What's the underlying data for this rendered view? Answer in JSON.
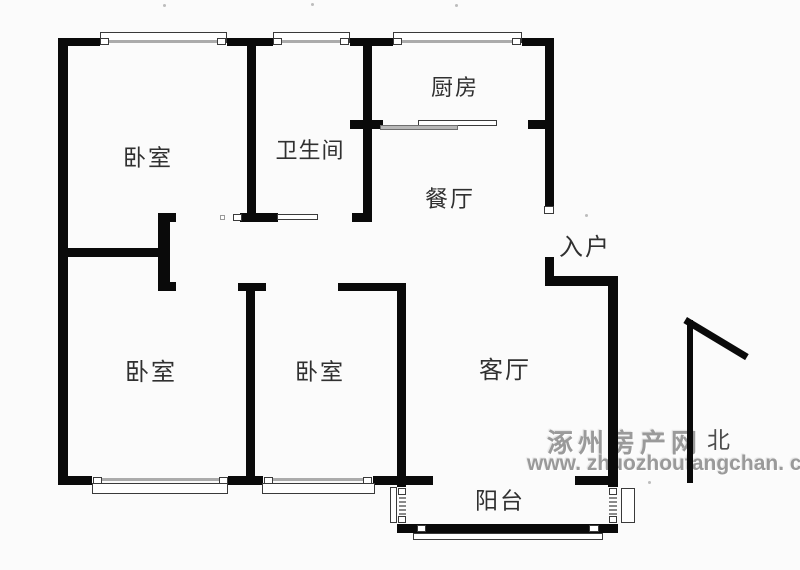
{
  "page": {
    "width": 800,
    "height": 570,
    "background": "#fbfbfb"
  },
  "colors": {
    "wall": "#0a0a0a",
    "thin_line": "#3a3a3a",
    "window_bar": "#ababab",
    "label_text": "#303030",
    "north_text": "#4d4d4d",
    "watermark": "#9a9a9a",
    "artifact_dot": "#bdbdbd"
  },
  "rooms": [
    {
      "id": "bedroom-top-left",
      "label": "卧室",
      "cx": 148,
      "cy": 158,
      "size": 23,
      "ls": 2
    },
    {
      "id": "bathroom",
      "label": "卫生间",
      "cx": 310,
      "cy": 151,
      "size": 22,
      "ls": 1
    },
    {
      "id": "kitchen",
      "label": "厨房",
      "cx": 455,
      "cy": 88,
      "size": 22,
      "ls": 2
    },
    {
      "id": "dining-room",
      "label": "餐厅",
      "cx": 450,
      "cy": 199,
      "size": 23,
      "ls": 2
    },
    {
      "id": "entry",
      "label": "入户",
      "cx": 585,
      "cy": 248,
      "size": 24,
      "ls": 2
    },
    {
      "id": "bedroom-bottom-left",
      "label": "卧室",
      "cx": 151,
      "cy": 373,
      "size": 24,
      "ls": 2
    },
    {
      "id": "bedroom-bottom-middle",
      "label": "卧室",
      "cx": 320,
      "cy": 372,
      "size": 23,
      "ls": 2
    },
    {
      "id": "living-room",
      "label": "客厅",
      "cx": 505,
      "cy": 371,
      "size": 24,
      "ls": 2
    },
    {
      "id": "balcony",
      "label": "阳台",
      "cx": 500,
      "cy": 501,
      "size": 23,
      "ls": 2
    }
  ],
  "north": {
    "label": "北",
    "x": 707,
    "y": 429
  },
  "watermark": {
    "line1": "涿州房产网",
    "line2": "www. zhuozhoufangchan. com"
  },
  "floorplan": {
    "walls": [
      [
        58,
        38,
        42,
        8
      ],
      [
        227,
        38,
        46,
        8
      ],
      [
        350,
        38,
        43,
        8
      ],
      [
        522,
        38,
        32,
        8
      ],
      [
        58,
        38,
        10,
        447
      ],
      [
        247,
        44,
        9,
        170
      ],
      [
        363,
        44,
        9,
        170
      ],
      [
        350,
        120,
        33,
        9
      ],
      [
        528,
        120,
        18,
        9
      ],
      [
        545,
        38,
        9,
        175
      ],
      [
        545,
        257,
        9,
        25
      ],
      [
        545,
        276,
        73,
        10
      ],
      [
        608,
        276,
        10,
        257
      ],
      [
        240,
        213,
        38,
        9
      ],
      [
        352,
        213,
        20,
        9
      ],
      [
        58,
        248,
        100,
        9
      ],
      [
        158,
        213,
        12,
        78
      ],
      [
        158,
        213,
        18,
        9
      ],
      [
        158,
        282,
        18,
        9
      ],
      [
        238,
        283,
        28,
        8
      ],
      [
        246,
        291,
        9,
        186
      ],
      [
        338,
        283,
        67,
        8
      ],
      [
        397,
        283,
        9,
        250
      ],
      [
        58,
        476,
        34,
        9
      ],
      [
        228,
        476,
        35,
        9
      ],
      [
        373,
        476,
        60,
        9
      ],
      [
        575,
        476,
        43,
        9
      ],
      [
        402,
        524,
        216,
        9
      ],
      [
        687,
        320,
        6,
        163
      ]
    ],
    "covers": [
      [
        397,
        487,
        9,
        37
      ],
      [
        608,
        487,
        10,
        37
      ]
    ],
    "thin_rects": [
      [
        100,
        32,
        127,
        11,
        "window-frame"
      ],
      [
        273,
        32,
        77,
        11,
        "window-frame"
      ],
      [
        393,
        32,
        129,
        11,
        "window-frame"
      ],
      [
        92,
        483,
        136,
        11,
        "window-frame"
      ],
      [
        262,
        483,
        113,
        11,
        "window-frame"
      ],
      [
        390,
        487,
        7,
        36,
        "window-frame"
      ],
      [
        621,
        488,
        14,
        35,
        "window-frame"
      ],
      [
        413,
        533,
        190,
        7,
        "balcony-sill"
      ],
      [
        417,
        525,
        9,
        7,
        "window-cap"
      ],
      [
        589,
        525,
        10,
        7,
        "window-cap"
      ],
      [
        277,
        214,
        41,
        6,
        "sliding-door"
      ],
      [
        233,
        214,
        9,
        7,
        "door-frame-mark"
      ],
      [
        544,
        206,
        10,
        8,
        "door-frame-mark"
      ],
      [
        418,
        120,
        79,
        6,
        "kitchen-counter"
      ]
    ],
    "gray_rects": [
      [
        380,
        125,
        78,
        5,
        "kitchen-counter"
      ]
    ],
    "light_rects": [
      [
        220,
        215,
        5,
        5,
        "door-swing-mark"
      ]
    ],
    "window_bars": [
      [
        108,
        40,
        110,
        3
      ],
      [
        281,
        40,
        60,
        3
      ],
      [
        401,
        40,
        112,
        3
      ],
      [
        101,
        478,
        118,
        3
      ],
      [
        272,
        478,
        92,
        3
      ]
    ],
    "window_caps": [
      [
        100,
        38,
        9,
        7
      ],
      [
        217,
        38,
        9,
        7
      ],
      [
        273,
        38,
        9,
        7
      ],
      [
        340,
        38,
        9,
        7
      ],
      [
        393,
        38,
        9,
        7
      ],
      [
        512,
        38,
        9,
        7
      ],
      [
        93,
        477,
        9,
        7
      ],
      [
        219,
        477,
        9,
        7
      ],
      [
        264,
        477,
        9,
        7
      ],
      [
        363,
        477,
        9,
        7
      ],
      [
        398,
        488,
        8,
        7
      ],
      [
        398,
        516,
        8,
        7
      ],
      [
        609,
        488,
        8,
        7
      ],
      [
        609,
        516,
        8,
        7
      ]
    ],
    "hatches": [
      [
        399,
        496,
        7,
        19
      ],
      [
        609,
        496,
        8,
        19
      ]
    ],
    "north_arrow": {
      "x": 687,
      "y": 317,
      "length": 72,
      "angle_deg": 31,
      "thickness": 7
    },
    "artifact_dots": [
      [
        163,
        4
      ],
      [
        311,
        3
      ],
      [
        455,
        4
      ],
      [
        585,
        214
      ],
      [
        648,
        481
      ]
    ]
  }
}
